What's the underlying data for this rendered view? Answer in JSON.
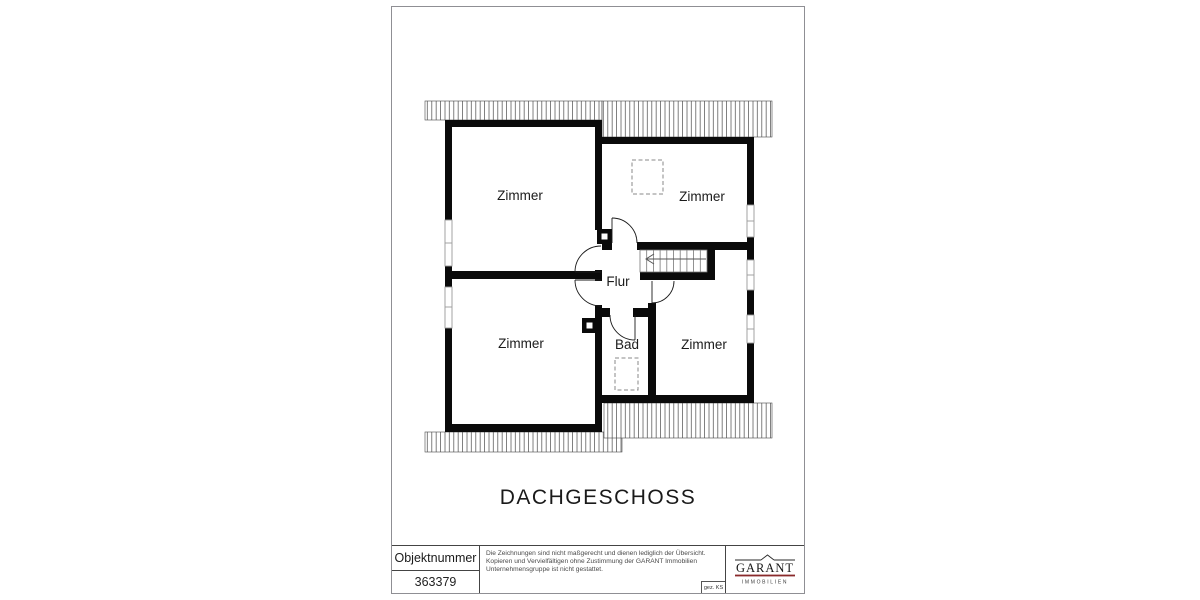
{
  "page": {
    "floor_title": "DACHGESCHOSS"
  },
  "plan": {
    "rooms": [
      {
        "label": "Zimmer"
      },
      {
        "label": "Zimmer"
      },
      {
        "label": "Flur"
      },
      {
        "label": "Zimmer"
      },
      {
        "label": "Bad"
      },
      {
        "label": "Zimmer"
      }
    ]
  },
  "title_block": {
    "object_number_label": "Objektnummer",
    "object_number_value": "363379",
    "disclaimer": {
      "line1": "Die Zeichnungen sind nicht maßgerecht und dienen lediglich der Übersicht.",
      "line2": "Kopieren und Vervielfältigen ohne Zustimmung der GARANT Immobilien",
      "line3": "Unternehmensgruppe ist nicht gestattet."
    },
    "signature": "gez. KS",
    "logo": {
      "brand": "GARANT",
      "subtitle": "IMMOBILIEN"
    }
  },
  "colors": {
    "wall": "#0a0a0a",
    "window_frame": "#999999",
    "hatch_line": "#4a4a4a",
    "logo_underline": "#8a2a2b",
    "frame_border": "#8f8f94"
  }
}
